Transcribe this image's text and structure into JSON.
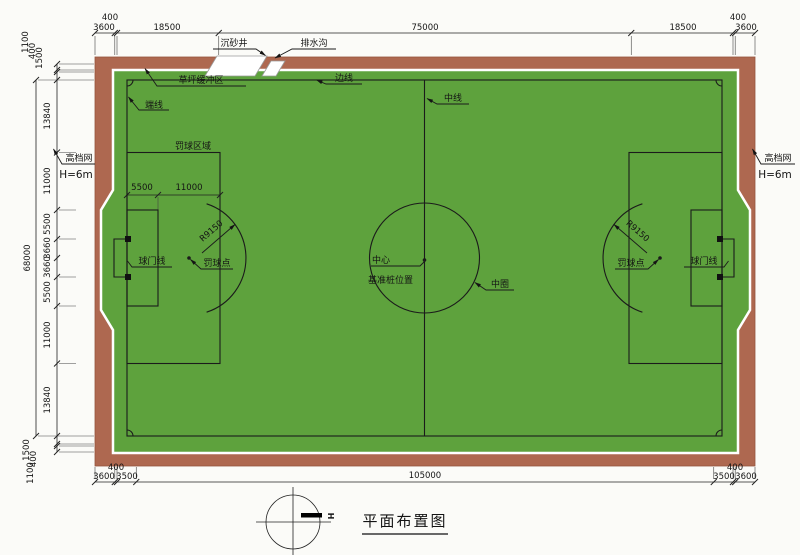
{
  "title": "平面布置图",
  "north_mark": "H",
  "colors": {
    "track": "#ae6850",
    "track_edge": "#96543e",
    "field": "#5ea23d",
    "line": "#1b1b1b"
  },
  "fence": {
    "name": "高档网",
    "height": "H=6m"
  },
  "features": {
    "settling_well": "沉砂井",
    "drain": "排水沟",
    "buffer_zone": "草坪缓冲区",
    "sideline": "边线",
    "endline": "端线",
    "centerline": "中线",
    "center": "中心",
    "datum": "基准桩位置",
    "center_circle": "中圈",
    "penalty_area": "罚球区域",
    "goal_line": "球门线",
    "penalty_spot": "罚球点",
    "arc_radius": "R9150"
  },
  "dims": {
    "top": [
      "3600",
      "400",
      "18500",
      "75000",
      "18500",
      "400",
      "3600"
    ],
    "bottom": [
      "3600",
      "400",
      "3500",
      "105000",
      "3500",
      "400",
      "3600"
    ],
    "left_outer": "68000",
    "left_top": [
      "1100",
      "400",
      "1500"
    ],
    "left_field": [
      "13840",
      "11000",
      "5500",
      "3660",
      "3660",
      "5500",
      "11000",
      "13840"
    ],
    "left_bottom": [
      "1500",
      "400",
      "1100"
    ],
    "penalty": [
      "5500",
      "11000"
    ]
  }
}
